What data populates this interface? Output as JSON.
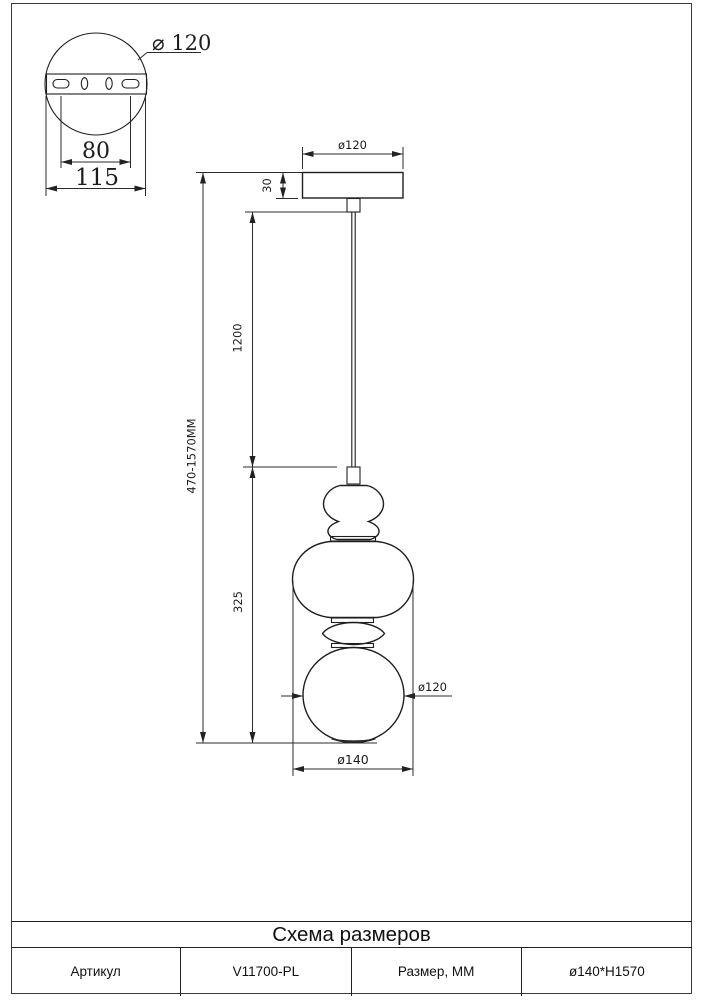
{
  "detail_view": {
    "plate_diameter": "⌀ 120",
    "slot_spacing": "80",
    "plate_width": "115"
  },
  "main_view": {
    "canopy_diameter": "ø120",
    "canopy_height": "30",
    "wire_length": "1200",
    "total_height": "470-1570MM",
    "body_height": "325",
    "sphere_diameter": "ø120",
    "body_diameter": "ø140"
  },
  "table": {
    "title": "Схема размеров",
    "article_label": "Артикул",
    "article_value": "V11700-PL",
    "size_label": "Размер, ММ",
    "size_value": "ø140*H1570"
  }
}
